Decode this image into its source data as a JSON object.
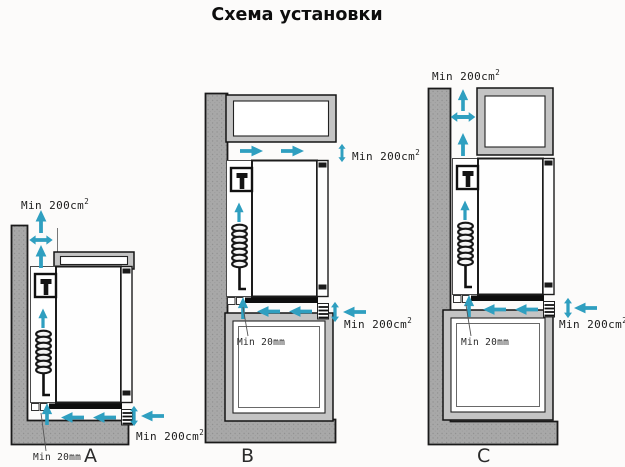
{
  "title": "Схема установки",
  "colors": {
    "arrow": "#2f9fc0",
    "wall": "#a8a8a8",
    "cabinet_frame": "#c4c4c4",
    "outline": "#1a1a1a"
  },
  "diagrams": [
    {
      "letter": "A",
      "labels": {
        "area_top": "Min 200cm",
        "area_top_sup": "2",
        "area_bottom": "Min 200cm",
        "area_bottom_sup": "2",
        "gap": "Min 20mm"
      }
    },
    {
      "letter": "B",
      "labels": {
        "area_top": "Min 200cm",
        "area_top_sup": "2",
        "area_bottom": "Min 200cm",
        "area_bottom_sup": "2",
        "gap": "Min 20mm"
      }
    },
    {
      "letter": "C",
      "labels": {
        "area_top": "Min 200cm",
        "area_top_sup": "2",
        "area_bottom": "Min 200cm",
        "area_bottom_sup": "2",
        "gap": "Min 20mm"
      }
    }
  ]
}
